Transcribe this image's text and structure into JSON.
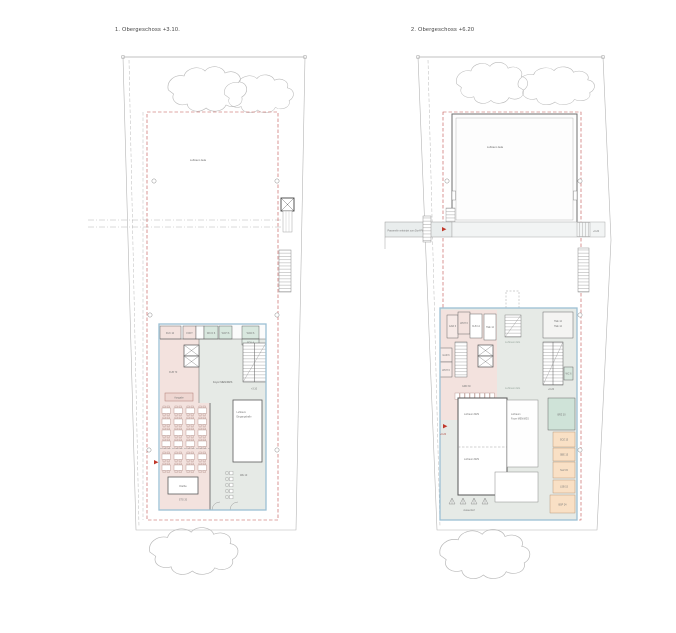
{
  "sheet": {
    "background": "#ffffff",
    "type": "architectural floor plans, two storeys side by side"
  },
  "colors": {
    "room_pink": "#f3e2de",
    "room_mint": "#d8e7de",
    "circulation_gray": "#e6eae6",
    "room_orange": "#f9e0c5",
    "building_outline_blue": "#9cc0d4",
    "boundary_red_dashed": "#c0504d",
    "exit_marker_red": "#c0392b"
  },
  "plan_left": {
    "title": "1. Obergeschoss  +3.10.",
    "labels": {
      "luftraum_aula": "Luftraum Aula",
      "room_kuk": "KUK 10",
      "room_fokt": "FOKT",
      "room_wcd": "WC D 6",
      "room_wch": "WCH 6",
      "room_wcd2": "WCD 6",
      "room_foy": "FOY 4",
      "room_kub": "KUB 70",
      "ausgabe": "Ausgabe",
      "foyer": "Foyer MEN/MZS",
      "level": "+3.10",
      "kueche": "Küche",
      "stg": "STG 20",
      "luftraum_line1": "Luftraum",
      "luftraum_line2": "Eingangshalle",
      "we": "WE 10"
    }
  },
  "plan_right": {
    "title": "2. Obergeschoss  +6.20",
    "labels": {
      "luftraum_aula": "Luftraum Aula",
      "passerelle": "Passerelle verbindet zum Dorf-Platz",
      "passerelle_level": "+6.20",
      "room_gar_top": "GAR 6",
      "room_wch_top": "WCH 6",
      "room_klb": "KLB 12",
      "room_tee_top": "TEE 12",
      "room_gar_side": "GAR 6",
      "room_wch_side": "WCH 6",
      "room_grd": "GRD 30",
      "room_tee1": "TEE 12",
      "room_tee2": "TEE 12",
      "room_wc": "WC 6",
      "level": "+6.20",
      "luftraum_eg_a": "Luftraum EG",
      "luftraum_eg_b": "Luftraum EG",
      "room_brz": "BRZ 30",
      "room_soz": "SOZ 15",
      "room_sbe": "SBE 15",
      "room_slz": "SLZ 15",
      "room_lsb": "LSB 15",
      "room_bsp": "BSP 24",
      "luftraum_mzs_a": "Luftraum MZS",
      "luftraum_mzs_b": "Luftraum MZS",
      "luftraum_foyer_line1": "Luftraum",
      "luftraum_foyer_line2": "Foyer MEN/MZS",
      "aussenhof": "Aussenhof",
      "exit_level": "+6.20"
    }
  }
}
